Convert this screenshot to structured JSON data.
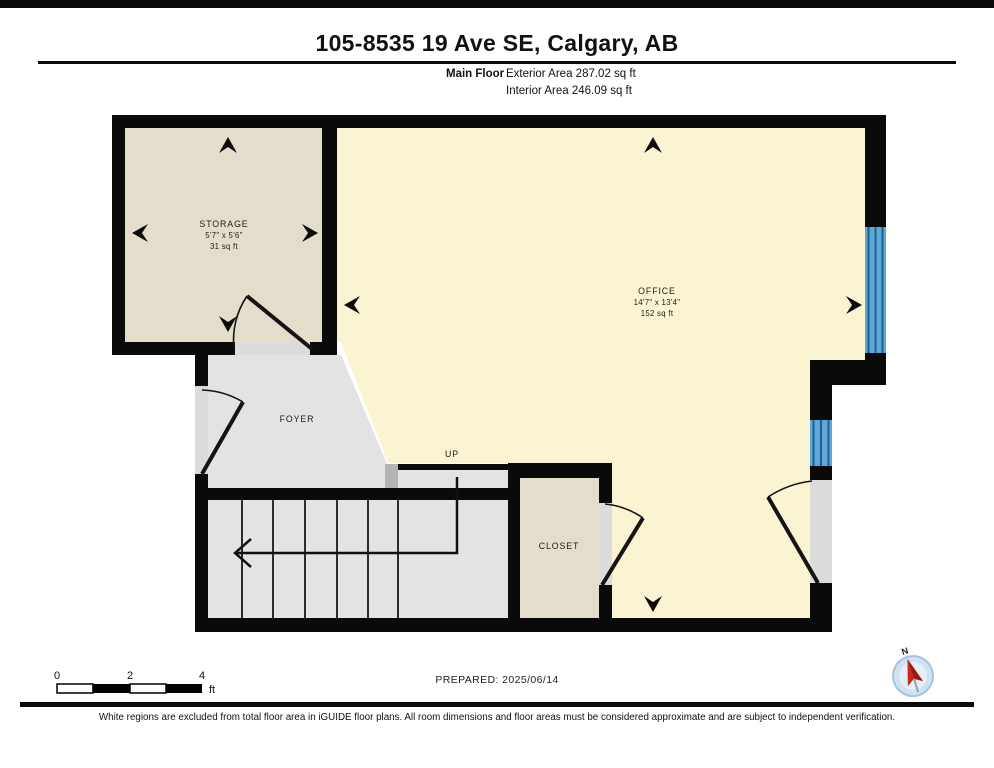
{
  "page": {
    "title": "105-8535 19 Ave SE, Calgary, AB"
  },
  "floor_summary": {
    "floor_label": "Main Floor",
    "exterior_area": "Exterior Area 287.02 sq ft",
    "interior_area": "Interior Area 246.09 sq ft"
  },
  "rooms": {
    "storage": {
      "name": "STORAGE",
      "dims": "5'7\" x 5'6\"",
      "area": "31 sq ft"
    },
    "office": {
      "name": "OFFICE",
      "dims": "14'7\" x 13'4\"",
      "area": "152 sq ft"
    },
    "foyer": {
      "name": "FOYER"
    },
    "closet": {
      "name": "CLOSET"
    },
    "stairs": {
      "direction_label": "UP"
    }
  },
  "scale_bar": {
    "ticks": [
      "0",
      "2",
      "4"
    ],
    "unit": "ft"
  },
  "compass": {
    "north_label": "N"
  },
  "footer": {
    "prepared_label": "PREPARED: 2025/06/14",
    "disclaimer": "White regions are excluded from total floor area in iGUIDE floor plans. All room dimensions and floor areas must be considered approximate and are subject to independent verification."
  },
  "colors": {
    "wall": "#0a0a0a",
    "room_fill": "#e4ddcb",
    "office_fill": "#fbf4d3",
    "circulation_fill": "#e3e3e3",
    "step_fill": "#b3b3b3",
    "opening_fill": "#dcdcdc",
    "window_fill": "#5fa8d3",
    "window_line": "#1d5f94",
    "compass_red": "#c8281e",
    "compass_blue": "#cfe2f2"
  }
}
